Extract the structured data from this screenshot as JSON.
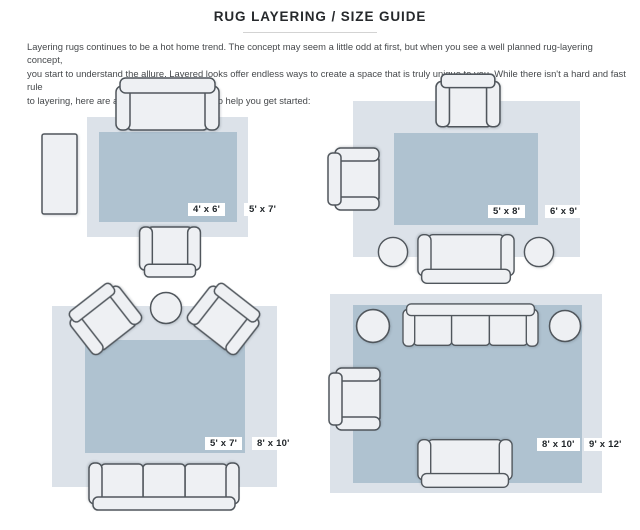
{
  "header": {
    "title": "RUG LAYERING / SIZE GUIDE",
    "intro_lines": [
      "Layering rugs continues to be a hot home trend. The concept may seem a little odd at first, but when you see a well planned rug-layering concept,",
      "you start to understand the allure. Layered looks offer endless ways to create a space that is truly unique to you. While there isn't a hard and fast rule",
      "to layering, here are a few size combinations to help you get started:"
    ]
  },
  "colors": {
    "outer_rug": "#dce2e9",
    "inner_rug": "#afc2d0",
    "furniture_fill": "#eef0f3",
    "furniture_outline": "#50565c",
    "label_bg": "#ffffff",
    "label_text": "#1f2428",
    "title_text": "#26292c",
    "divider": "#d3d3d3"
  },
  "layouts": [
    {
      "id": "top-left",
      "inner_size": "4' x 6'",
      "outer_size": "5' x 7'"
    },
    {
      "id": "top-right",
      "inner_size": "5' x 8'",
      "outer_size": "6' x 9'"
    },
    {
      "id": "bottom-left",
      "inner_size": "5' x 7'",
      "outer_size": "8' x 10'"
    },
    {
      "id": "bottom-right",
      "inner_size": "8' x 10'",
      "outer_size": "9' x 12'"
    }
  ]
}
